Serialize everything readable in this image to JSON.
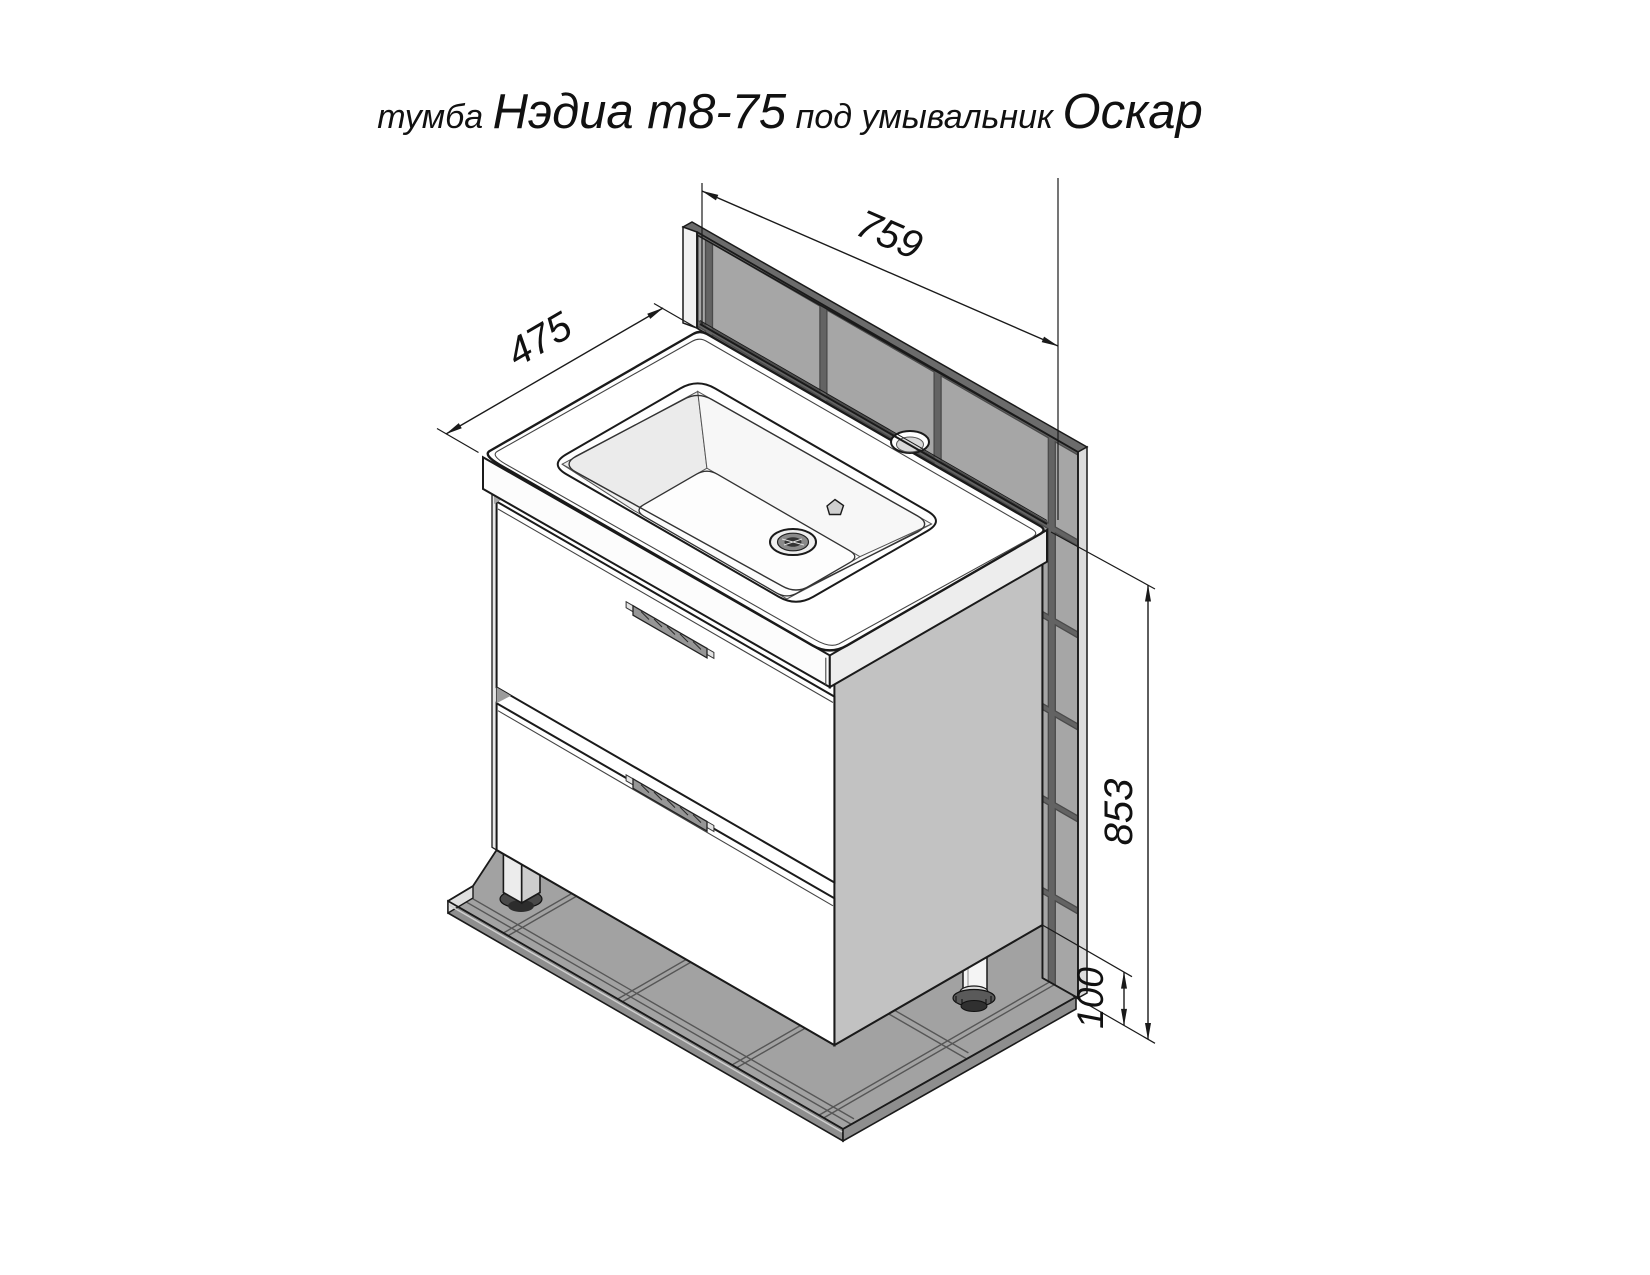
{
  "title": {
    "prefix": "тумба ",
    "model": "Нэдиа т8-75",
    "middle": " под умывальник ",
    "sink_model": "Оскар"
  },
  "dimensions": {
    "width_mm": "759",
    "depth_mm": "475",
    "height_mm": "853",
    "plinth_height_mm": "100"
  },
  "colors": {
    "line": "#1a1a1a",
    "tile_fill": "#a6a6a6",
    "tile_grout": "#4a4a4a",
    "wall_top_edge": "#6b6b6b",
    "cabinet_side_panel": "#c2c2c2",
    "drawer_front": "#ffffff",
    "background": "#ffffff"
  }
}
